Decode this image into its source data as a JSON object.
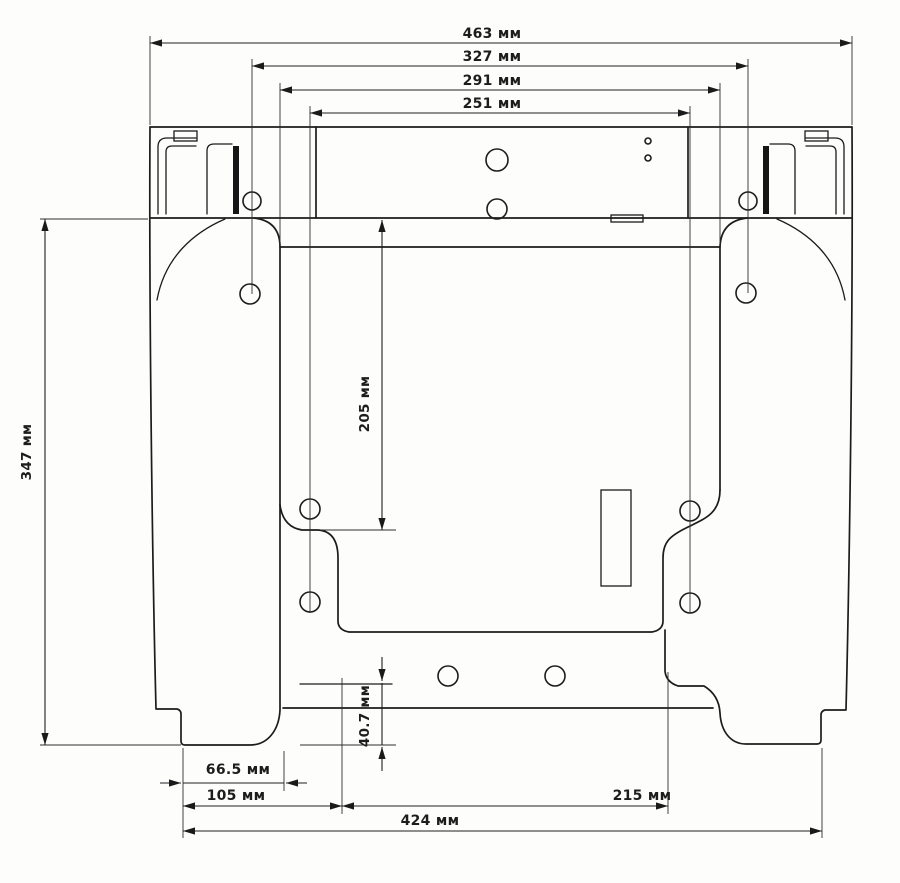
{
  "drawing": {
    "type": "technical-dimension-drawing",
    "unit": "мм",
    "dimension_labels": {
      "w463": "463 мм",
      "w327": "327 мм",
      "w291": "291 мм",
      "w251": "251 мм",
      "h347": "347 мм",
      "h205": "205 мм",
      "h40_7": "40.7 мм",
      "w66_5": "66.5 мм",
      "w105": "105 мм",
      "w215": "215 мм",
      "w424": "424 мм"
    },
    "dimensions": [
      {
        "id": "overall-top-width",
        "value": 463,
        "unit": "мм",
        "orientation": "horizontal",
        "position": "top"
      },
      {
        "id": "upper-hole-spacing",
        "value": 327,
        "unit": "мм",
        "orientation": "horizontal",
        "position": "top"
      },
      {
        "id": "inner-edge-spacing",
        "value": 291,
        "unit": "мм",
        "orientation": "horizontal",
        "position": "top"
      },
      {
        "id": "center-hole-spacing",
        "value": 251,
        "unit": "мм",
        "orientation": "horizontal",
        "position": "top"
      },
      {
        "id": "overall-height",
        "value": 347,
        "unit": "мм",
        "orientation": "vertical",
        "position": "left"
      },
      {
        "id": "mid-height",
        "value": 205,
        "unit": "мм",
        "orientation": "vertical",
        "position": "middle"
      },
      {
        "id": "flange-foot-height",
        "value": 40.7,
        "unit": "мм",
        "orientation": "vertical",
        "position": "bottom-middle"
      },
      {
        "id": "foot-to-edge",
        "value": 66.5,
        "unit": "мм",
        "orientation": "horizontal",
        "position": "bottom"
      },
      {
        "id": "foot-to-flange",
        "value": 105,
        "unit": "мм",
        "orientation": "horizontal",
        "position": "bottom"
      },
      {
        "id": "flange-width",
        "value": 215,
        "unit": "мм",
        "orientation": "horizontal",
        "position": "bottom"
      },
      {
        "id": "overall-bottom-width",
        "value": 424,
        "unit": "мм",
        "orientation": "horizontal",
        "position": "bottom"
      }
    ],
    "line_color": "#1c1c1c",
    "background_color": "#fdfdfc"
  }
}
